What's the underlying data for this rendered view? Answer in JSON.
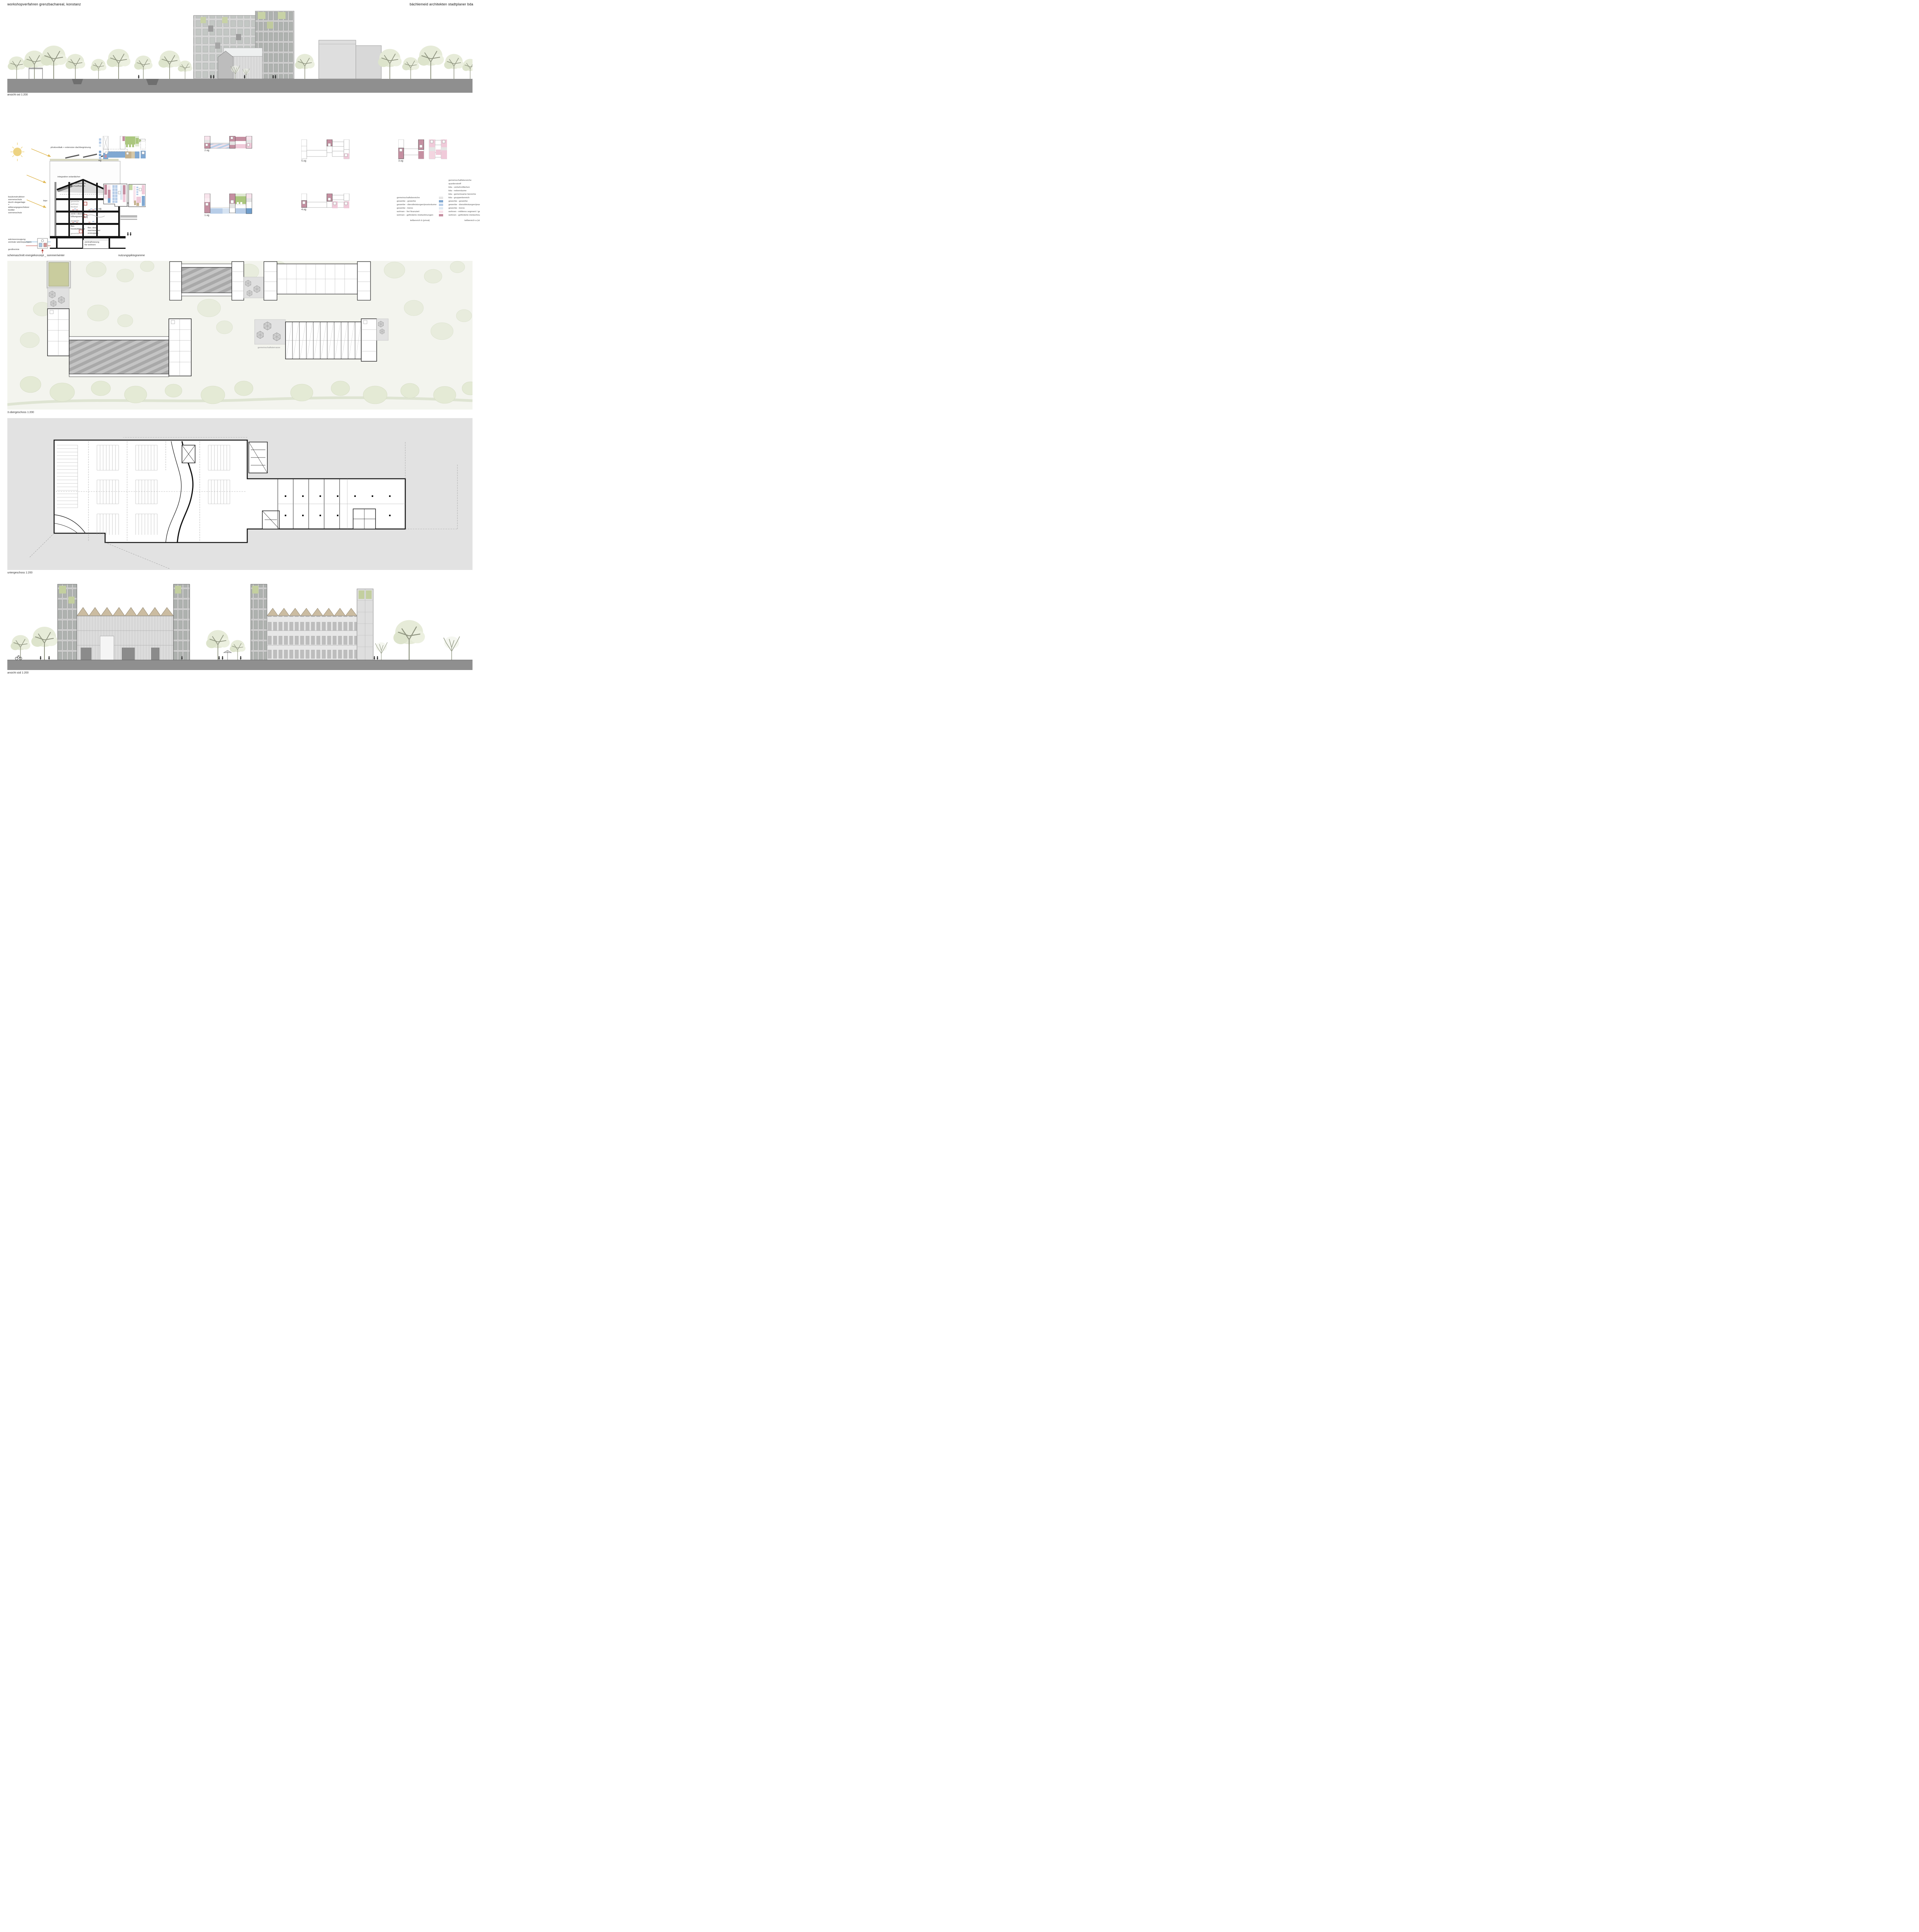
{
  "header": {
    "left": "workshopverfahren grenzbachareal, konstanz",
    "right": "bächlemeid architekten stadtplaner bda"
  },
  "sections": {
    "elevation_east": {
      "caption": "ansicht ost 1:200"
    },
    "energy": {
      "caption": "schemaschnitt energiekonzept _ sommer/winter",
      "labels": {
        "photovoltaik": "photovoltaik + extensive dachbegrünung",
        "solardaecher": "integrative solardächer",
        "dachaufbauten": "hochgedämmte\ndachaufbauten",
        "bipv": "bipv",
        "gewerbe_wohnen": "gewerbe\nwohnen\nflexibel",
        "lueftung": "zentr.+dezentr.\nlüftungsanlage",
        "gewerbe_mitte": "gewerbe",
        "heizkuehldecke": "flex.\nheizkühldecke",
        "warmwasser": "flex. dez.\nwarmwasser\nerzeugung",
        "gewerbe_unten": "gewerbe",
        "zentralheizung": "zentralheizung\nfür wohnen",
        "sonnenschutz": "baukonstruktiver\nsonnenschutz\ndurch steganlage\n+\nwitterungsgeschützer\ntextiler\nsonnenschutz",
        "waermeerzeugung": "wärmeerzeugung\nzentrale wärmepumpen",
        "geothermie": "geothermie"
      }
    },
    "piktogramme": {
      "caption": "nutzungspiktogramme",
      "columns": [
        {
          "top": "eg",
          "bottom": "ug"
        },
        {
          "top": "2.og",
          "bottom": "1.og"
        },
        {
          "top": "5.og",
          "bottom": "4.og"
        },
        {
          "top": "3.og",
          "bottom": ""
        }
      ]
    },
    "legend": {
      "left": {
        "title": "teilbereich b (privat)",
        "items": [
          {
            "label": "gemeinschaftsbereiche",
            "color": "#e4e4e4"
          },
          {
            "label": "gewerbe - gewerbe",
            "color": "#80a8d2"
          },
          {
            "label": "gewerbe - dienstleistungen/praxisräume",
            "color": "#b7cde8"
          },
          {
            "label": "gewerbe - büros",
            "color": "#dde8f2"
          },
          {
            "label": "wohnen - frei finanziert",
            "color": "#f8e4ec"
          },
          {
            "label": "wohnen - geförderte mietwohnungen",
            "color": "#c58fa1"
          }
        ]
      },
      "right": {
        "title": "teilbereich a (städtisch)",
        "items": [
          {
            "label": "gemeinschaftsbereiche",
            "color": "#e4e4e4"
          },
          {
            "label": "quartierstreff",
            "color": "#c5b28e"
          },
          {
            "label": "kita - verkehrsflächen",
            "color": "#e0e9d3"
          },
          {
            "label": "kita - nebenräume",
            "color": "#c5d8a5"
          },
          {
            "label": "kita - gemeinsame bereiche",
            "color": "#abc77f"
          },
          {
            "label": "kita - gruppenbereich",
            "color": "#a2bf6f"
          },
          {
            "label": "gewerbe - gewerbe",
            "color": "#80a8d2"
          },
          {
            "label": "gewerbe - dienstleistungen/praxisräume",
            "color": "#b7cde8"
          },
          {
            "label": "gewerbe - büros",
            "color": "#dde8f2"
          },
          {
            "label": "wohnen - mittleres segment / genossenschaftlich",
            "color": "#f0cad9"
          },
          {
            "label": "wohnen - geförderte mietwohnungen",
            "color": "#c58fa1"
          }
        ]
      }
    },
    "plan_3og": {
      "caption": "3.obergeschoss 1:200",
      "terrasse_label": "gemeinschaftsterrasse"
    },
    "plan_ug": {
      "caption": "untergeschoss 1:200"
    },
    "elevation_south": {
      "caption": "ansicht süd 1:200"
    }
  },
  "palette": {
    "ground": "#8f8f8f",
    "parking_bg": "#e2e2e2",
    "pool": "#c9cc9e",
    "site_bg": "#f3f4ee",
    "sun": "#edd382"
  }
}
